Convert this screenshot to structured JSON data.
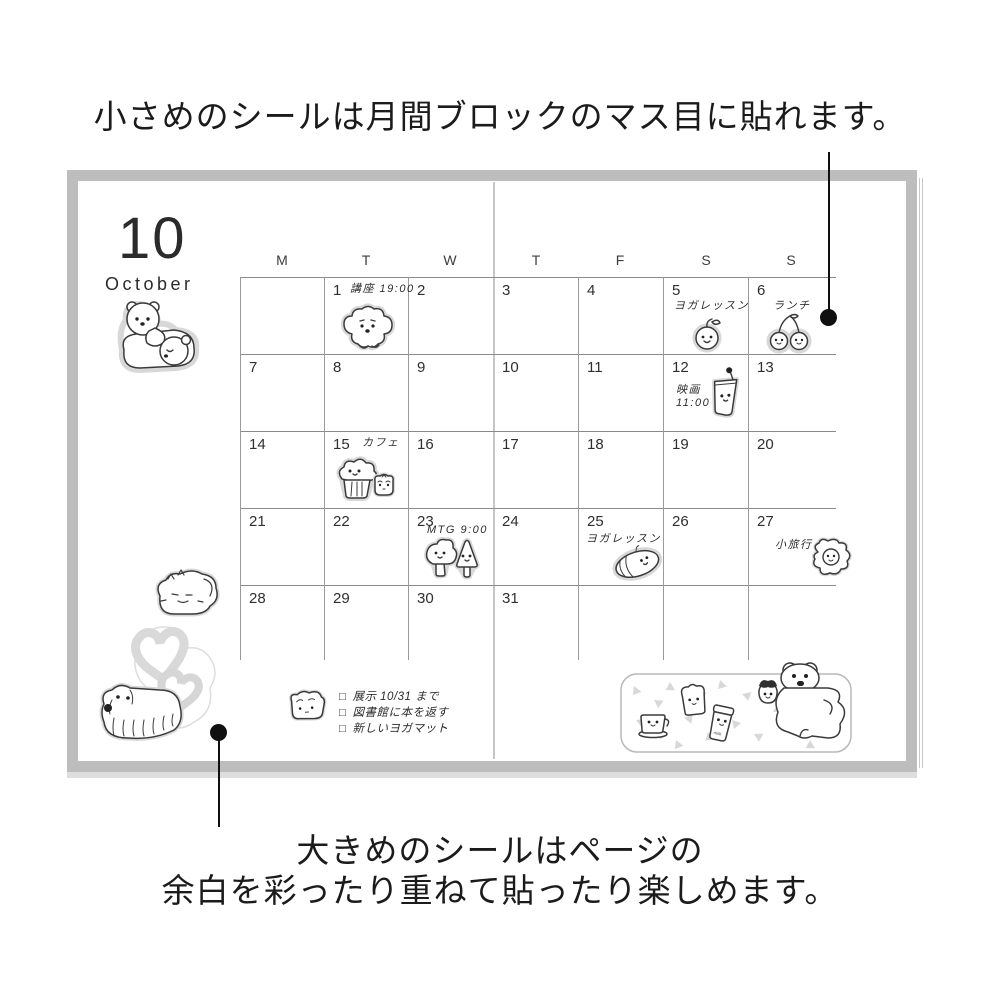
{
  "captions": {
    "top": "小さめのシールは月間ブロックのマス目に貼れます。",
    "bottom_line1": "大きめのシールはページの",
    "bottom_line2": "余白を彩ったり重ねて貼ったり楽しめます。"
  },
  "planner": {
    "month_number": "10",
    "month_name": "October",
    "day_headers": [
      "M",
      "T",
      "W",
      "T",
      "F",
      "S",
      "S"
    ],
    "weeks": [
      [
        "",
        "1",
        "2",
        "3",
        "4",
        "5",
        "6"
      ],
      [
        "7",
        "8",
        "9",
        "10",
        "11",
        "12",
        "13"
      ],
      [
        "14",
        "15",
        "16",
        "17",
        "18",
        "19",
        "20"
      ],
      [
        "21",
        "22",
        "23",
        "24",
        "25",
        "26",
        "27"
      ],
      [
        "28",
        "29",
        "30",
        "31",
        "",
        "",
        ""
      ]
    ],
    "events": [
      {
        "date": "1",
        "text": "講座 19:00"
      },
      {
        "date": "5",
        "text": "ヨガレッスン"
      },
      {
        "date": "6",
        "text": "ランチ"
      },
      {
        "date": "12",
        "text": "映画",
        "text2": "11:00"
      },
      {
        "date": "15",
        "text": "カフェ"
      },
      {
        "date": "23",
        "text": "MTG 9:00"
      },
      {
        "date": "25",
        "text": "ヨガレッスン"
      },
      {
        "date": "27",
        "text": "小旅行"
      }
    ],
    "checklist": {
      "checkbox_glyph": "□",
      "items": [
        "展示 10/31 まで",
        "図書館に本を返す",
        "新しいヨガマット"
      ]
    },
    "milk_jar_label": "milk",
    "stickers": [
      "polar-bears",
      "poodle-dog",
      "apple",
      "cherries",
      "drink-cup",
      "muffin",
      "mini-bread",
      "trees",
      "bread-roll",
      "fried-egg",
      "fluffy-cat",
      "double-hearts",
      "shaggy-dog",
      "toast-note-bread",
      "picnic-cluster (coffee-cup, toast, milk-jar, strawberry, white-bear)"
    ]
  },
  "colors": {
    "callout": "#101010",
    "text": "#1e1e1e",
    "notebook_border": "#bdbdbd",
    "grid_line": "#8a8a8a",
    "sticker_line": "#3a3a3a",
    "sticker_edge": "#d8d8d8",
    "heart_gray": "#d9d9d9",
    "confetti_gray": "#d8d8d8"
  }
}
